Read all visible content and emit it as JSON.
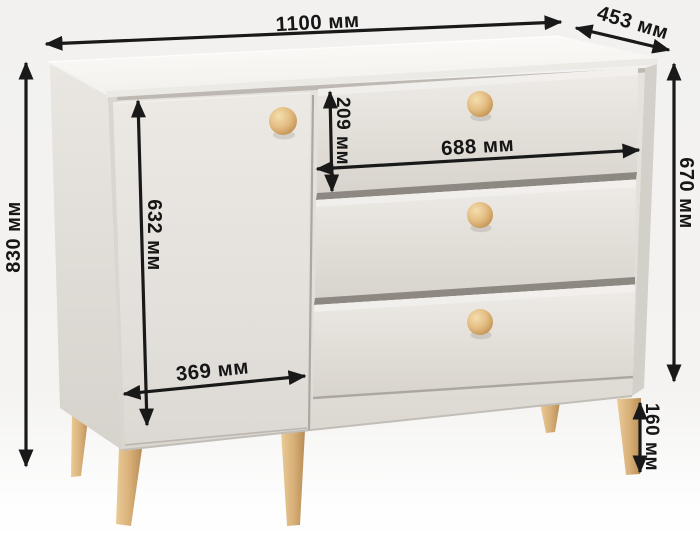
{
  "diagram": {
    "description": "Dimensioned product drawing of a sideboard / chest with one door and three drawers on tapered wooden legs",
    "unit_suffix": "мм",
    "dimensions": {
      "overall_width": {
        "label": "1100 мм",
        "value_mm": 1100,
        "location": "top, full width"
      },
      "depth": {
        "label": "453 мм",
        "value_mm": 453,
        "location": "top right, depth of top panel"
      },
      "overall_height": {
        "label": "830 мм",
        "value_mm": 830,
        "location": "left side, floor to top"
      },
      "carcass_height": {
        "label": "670 мм",
        "value_mm": 670,
        "location": "right side, body height"
      },
      "drawer_front_height": {
        "label": "209 мм",
        "value_mm": 209,
        "location": "first drawer front height"
      },
      "drawer_front_width": {
        "label": "688 мм",
        "value_mm": 688,
        "location": "drawer front width"
      },
      "door_height": {
        "label": "632 мм",
        "value_mm": 632,
        "location": "door height"
      },
      "door_width": {
        "label": "369 мм",
        "value_mm": 369,
        "location": "door width"
      },
      "leg_height": {
        "label": "160 мм",
        "value_mm": 160,
        "location": "leg height"
      }
    },
    "furniture": {
      "parts": [
        "top panel",
        "left hinged door with round wooden knob",
        "three drawers with round wooden knobs",
        "five splayed tapered wooden legs"
      ]
    },
    "colors": {
      "background_top": "#f2f1ef",
      "background_bottom": "#ffffff",
      "body": "#e5e1dc",
      "top_panel": "#fcfbf9",
      "knob_wood": "#e3bc82",
      "leg_wood": "#d8b07c",
      "dimension_ink": "#191919"
    }
  }
}
